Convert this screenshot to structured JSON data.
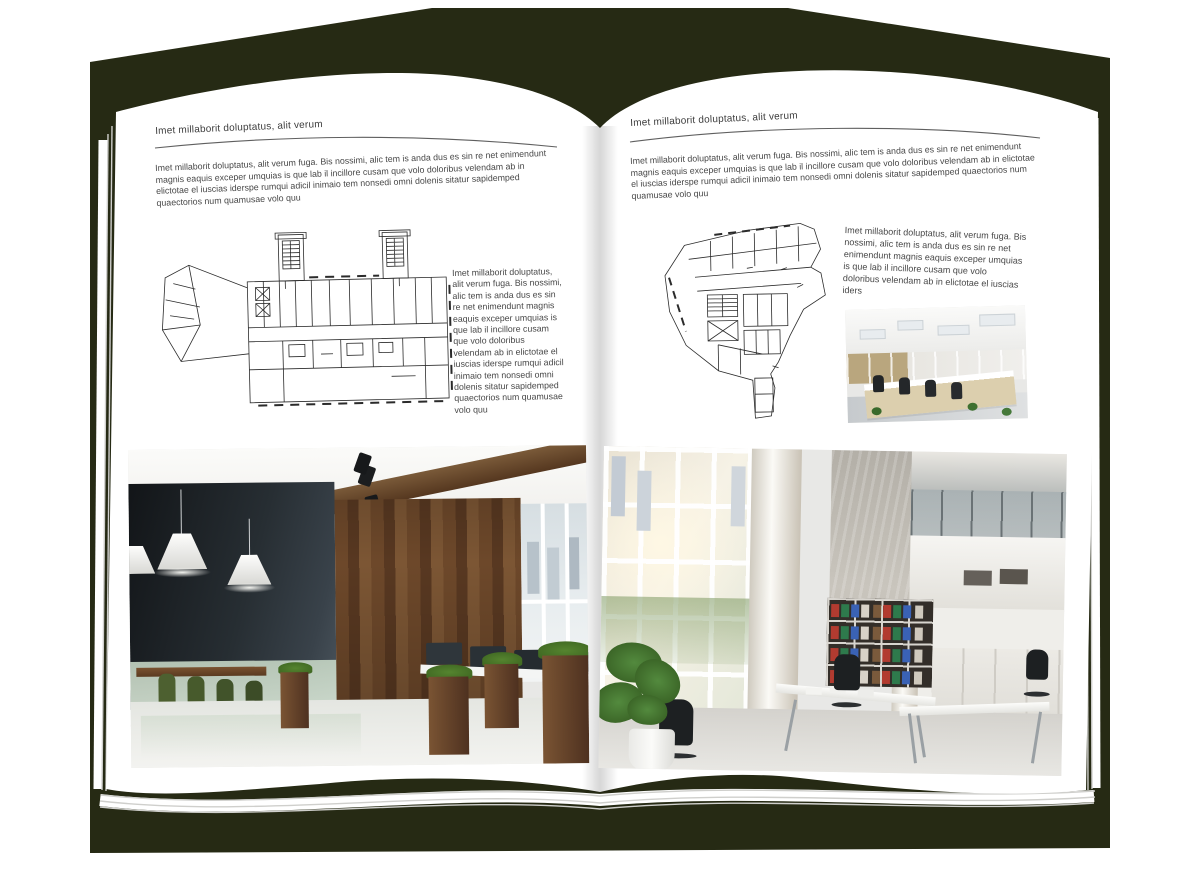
{
  "page_texts": {
    "left": {
      "header": "Imet millaborit doluptatus, alit verum",
      "intro": "Imet millaborit doluptatus, alit verum fuga. Bis nossimi, alic tem is anda dus es sin re net enimendunt magnis eaquis exceper umquias is que lab il incillore cusam que volo doloribus velendam ab in elictotae el iuscias iderspe rumqui adicil inimaio tem nonsedi omni dolenis sitatur sapidemped quaectorios num quamusae volo quu",
      "sidebar": "Imet millaborit doluptatus, alit verum fuga. Bis nossimi, alic tem is anda dus es sin re net enimendunt magnis eaquis exceper umquias is que lab il incillore cusam que volo doloribus velendam ab in elictotae el iuscias iderspe rumqui adicil inimaio tem nonsedi omni dolenis sitatur sapidemped quaectorios num quamusae volo quu"
    },
    "right": {
      "header": "Imet millaborit doluptatus, alit verum",
      "intro": "Imet millaborit doluptatus, alit verum fuga. Bis nossimi, alic tem is anda dus es sin re net enimendunt magnis eaquis exceper umquias is que lab il incillore cusam que volo doloribus velendam ab in elictotae el iuscias iderspe rumqui adicil inimaio tem nonsedi omni dolenis sitatur sapidemped quaectorios num quamusae volo quu",
      "sidebar": "Imet millaborit doluptatus, alit verum fuga. Bis nossimi, alic tem is anda dus es sin re net enimendunt magnis eaquis exceper umquias is que lab il incillore cusam que volo doloribus velendam ab in elictotae el iuscias iders"
    }
  },
  "colors": {
    "canvas": "#ffffff",
    "cover": "#262a14",
    "page": "#ffffff",
    "heading_text": "#3d3d3d",
    "body_text": "#474747",
    "rule": "#5f5f5f",
    "plan_ink": "#2b2b2b"
  }
}
